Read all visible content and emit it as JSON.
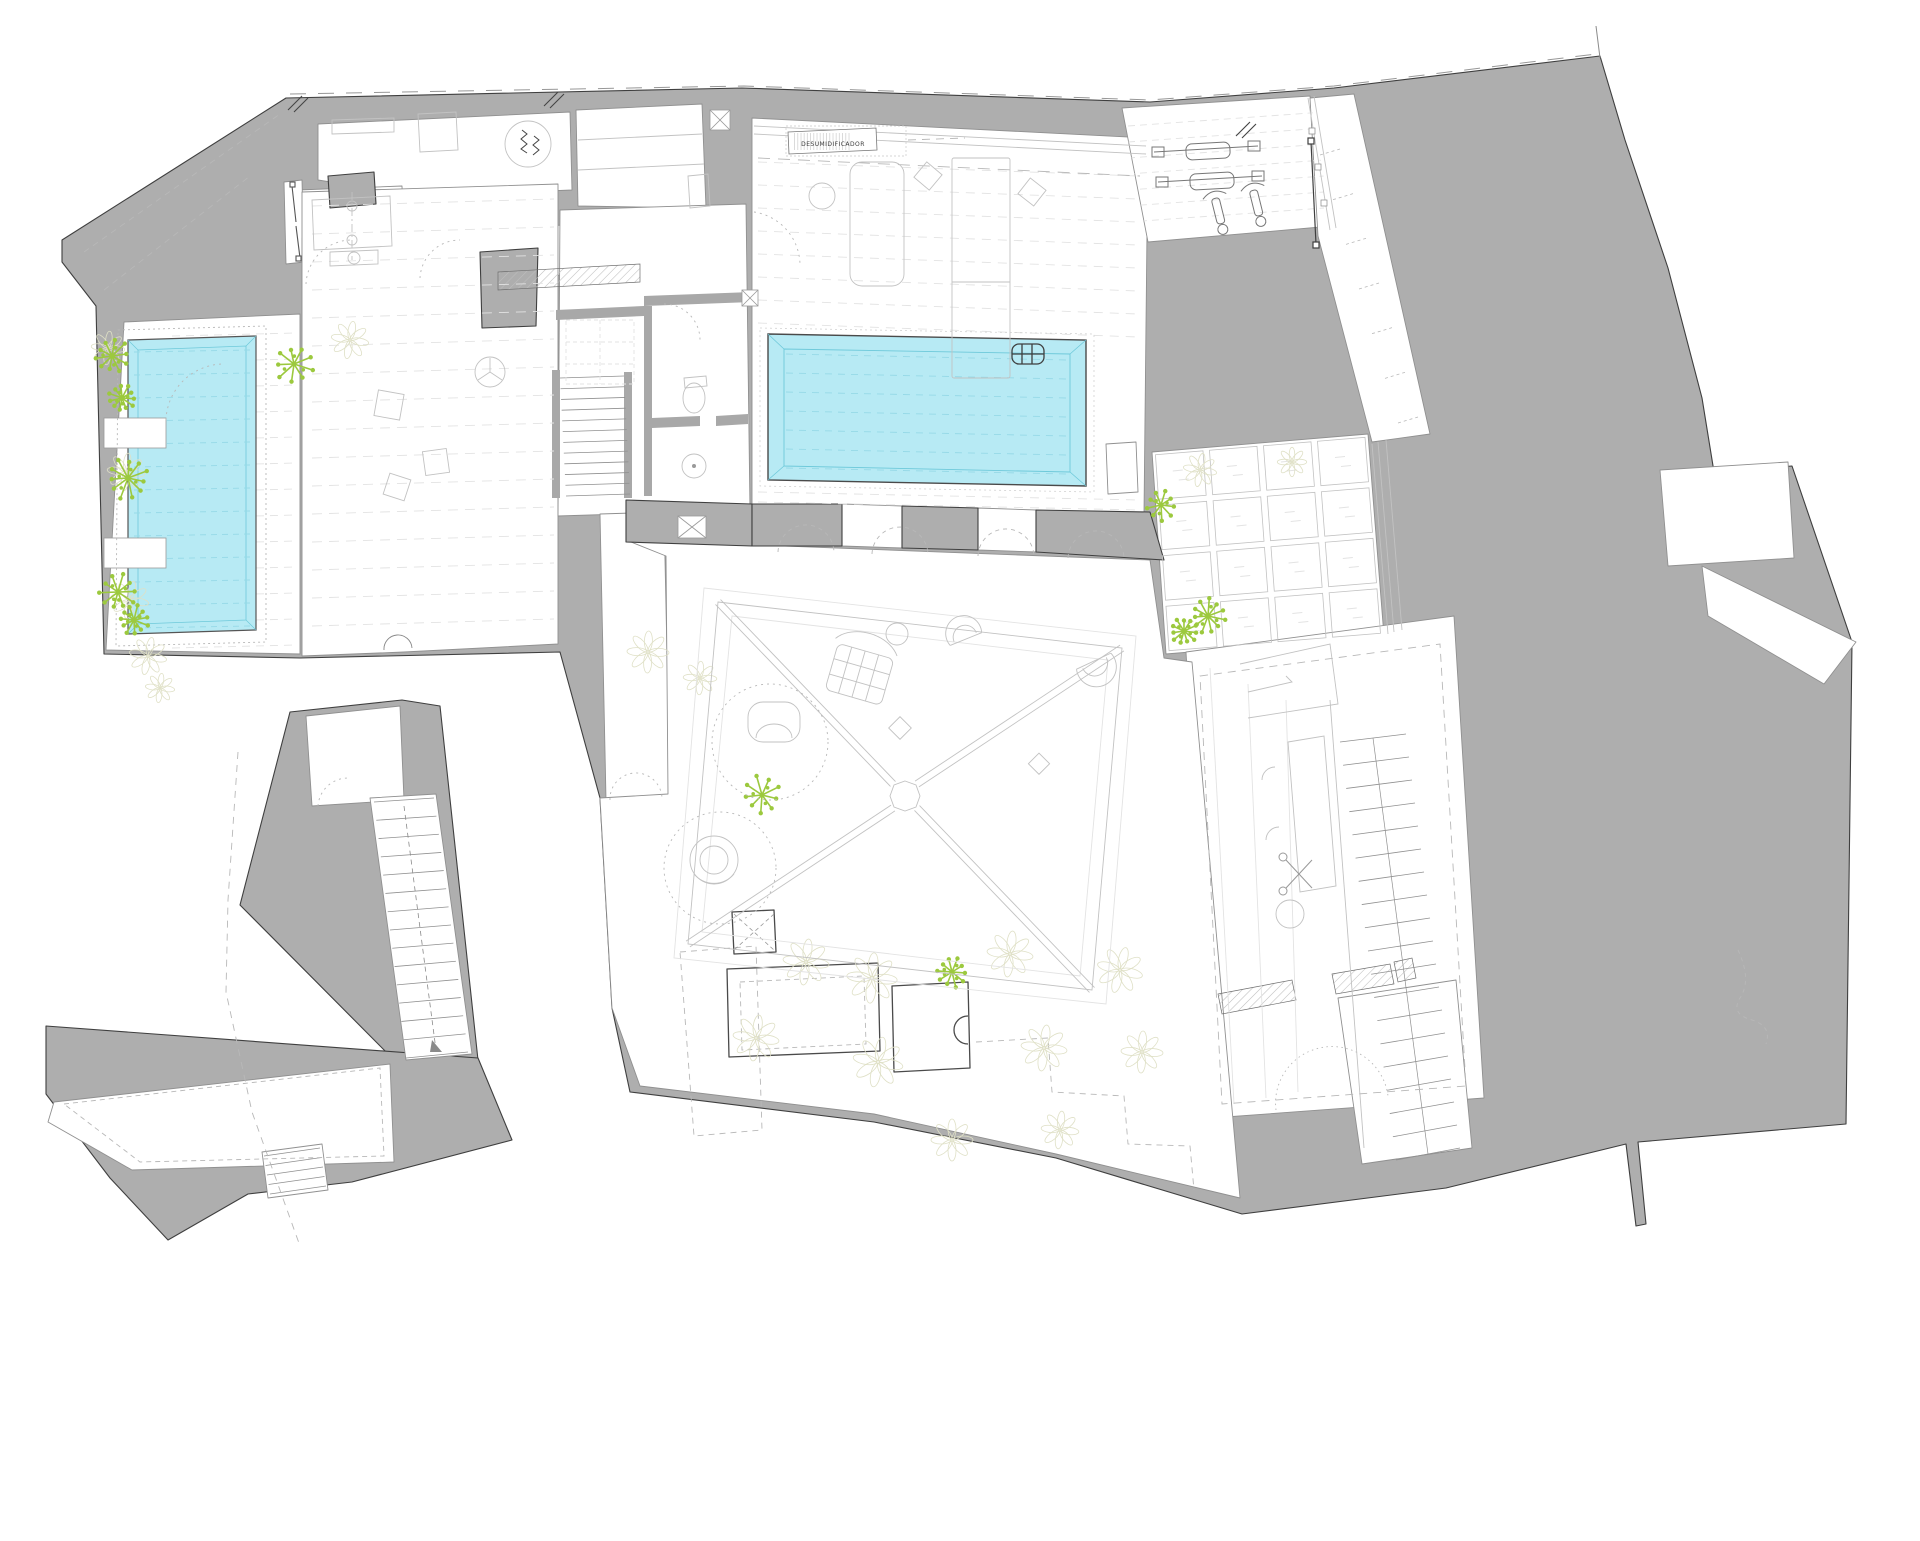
{
  "plan": {
    "equipment_label": "DESUMIDIFICADOR",
    "pool_count": 2,
    "colors": {
      "wall": "#aeaeae",
      "wall_edge": "#3f3f3f",
      "room_line": "#909090",
      "light_line": "#c2c2c2",
      "faint_line": "#e3e3e3",
      "pool": "#b7eaf4",
      "pool_line": "#96d9e7",
      "pool_rim": "#6ec9da",
      "plant": "#9cc93e",
      "foliage": "#dfe0c6",
      "dash": "#b8b8b8",
      "hatch": "#bdbdbd",
      "paper": "#ffffff",
      "ink": "#444444"
    },
    "icons": [
      "starburst-tree-icon",
      "foliage-plant-icon",
      "pool-ladder-icon",
      "scissors-icon",
      "door-swing-icon",
      "cross-shaft-icon",
      "stair-icon",
      "exercise-bike-icon",
      "weight-bench-icon",
      "toilet-icon",
      "shower-drain-icon",
      "survey-mark-icon"
    ]
  }
}
